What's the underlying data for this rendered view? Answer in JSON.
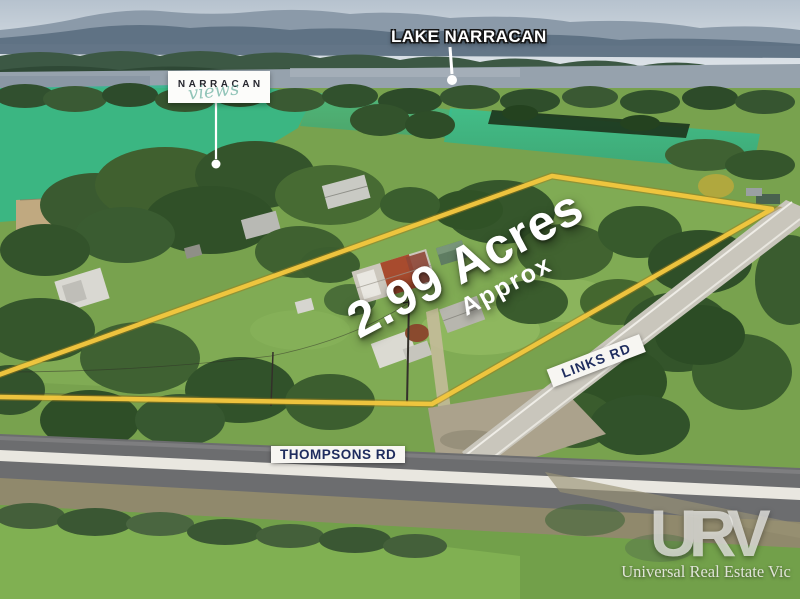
{
  "scene": {
    "type": "aerial-property-photo"
  },
  "labels": {
    "lake": "LAKE NARRACAN",
    "estate_name": "NARRACAN",
    "estate_script": "views",
    "area_value": "2.99 Acres",
    "area_qualifier": "Approx",
    "links_road": "LINKS RD",
    "thompsons_road": "THOMPSONS RD"
  },
  "watermark": {
    "logo": "URV",
    "tagline": "Universal Real Estate Vic"
  },
  "colors": {
    "boundary_yellow": "#f2c63f",
    "banner_navy": "#1e2c5e",
    "overlay_teal": "#2dbb8e",
    "label_white": "#ffffff",
    "watermark_gray": "#e6e6e2"
  }
}
